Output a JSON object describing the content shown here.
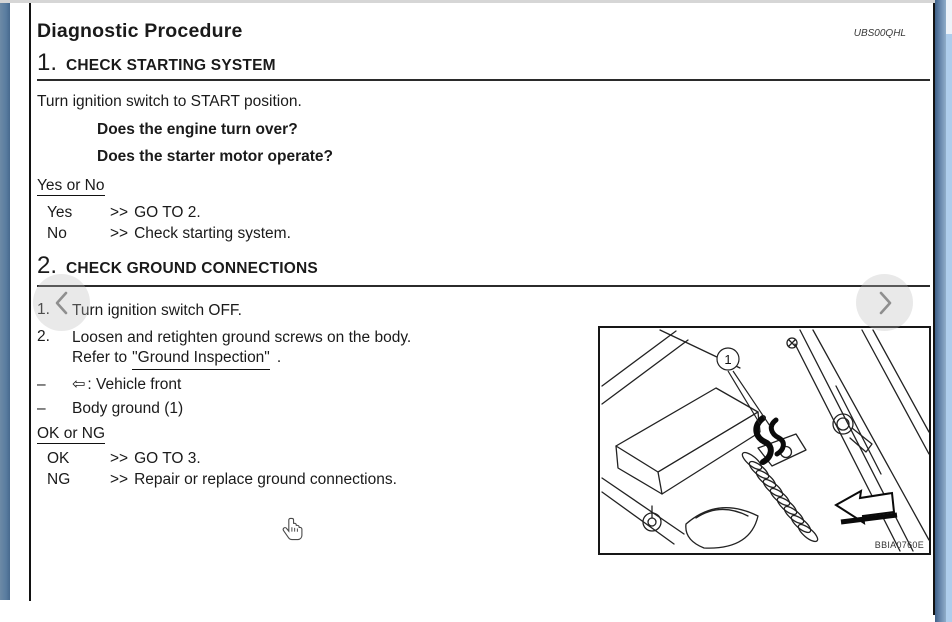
{
  "page": {
    "title": "Diagnostic Procedure",
    "code": "UBS00QHL"
  },
  "section1": {
    "number": "1.",
    "heading": "CHECK STARTING SYSTEM",
    "intro": "Turn ignition switch to START position.",
    "questions": [
      "Does the engine turn over?",
      "Does the starter motor operate?"
    ],
    "decision_label": "Yes or No",
    "outcomes": [
      {
        "option": "Yes",
        "arrow": ">>",
        "action": "GO TO 2."
      },
      {
        "option": "No",
        "arrow": ">>",
        "action": "Check starting system."
      }
    ]
  },
  "section2": {
    "number": "2.",
    "heading": "CHECK GROUND CONNECTIONS",
    "steps": [
      {
        "number": "1.",
        "text": "Turn ignition switch OFF."
      },
      {
        "number": "2.",
        "text": "Loosen and retighten ground screws on the body.",
        "refer_prefix": "Refer to",
        "link": "\"Ground Inspection\"",
        "suffix": "."
      }
    ],
    "notes": [
      {
        "bullet": "–",
        "icon": "⇦",
        "text": ": Vehicle front"
      },
      {
        "bullet": "–",
        "icon": "",
        "text": "Body ground (1)"
      }
    ],
    "decision_label": "OK or NG",
    "outcomes": [
      {
        "option": "OK",
        "arrow": ">>",
        "action": "GO TO 3."
      },
      {
        "option": "NG",
        "arrow": ">>",
        "action": "Repair or replace ground connections."
      }
    ]
  },
  "figure": {
    "callout": "1",
    "code": "BBIA0760E"
  },
  "icons": {
    "prev": "chevron-left",
    "next": "chevron-right",
    "vehicle_front": "hollow-left-arrow",
    "cursor": "hand-pointer"
  },
  "colors": {
    "frame_border": "#121212",
    "left_edge_bar": "#597c9f",
    "right_edge_bar": "#3e6088",
    "scroll_strip": "#aecdec",
    "nav_circle": "rgba(188,188,188,0.32)"
  }
}
